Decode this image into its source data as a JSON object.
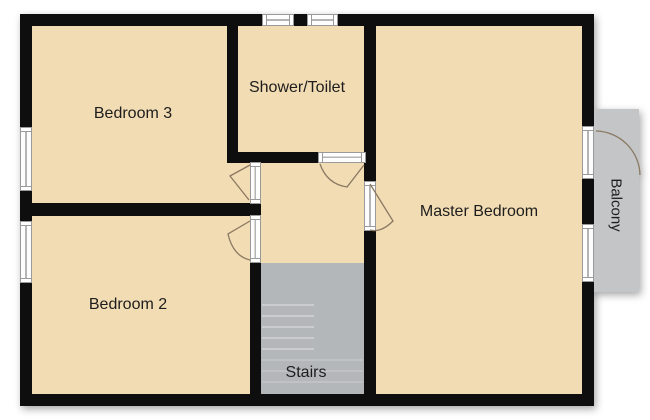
{
  "plan": {
    "rooms": {
      "bedroom3": {
        "label": "Bedroom 3"
      },
      "shower_toilet": {
        "label": "Shower/Toilet"
      },
      "master_bedroom": {
        "label": "Master Bedroom"
      },
      "bedroom2": {
        "label": "Bedroom 2"
      },
      "stairs": {
        "label": "Stairs"
      },
      "balcony": {
        "label": "Balcony"
      }
    },
    "colors": {
      "floor": "#f2dcb3",
      "wall": "#0e0e0e",
      "stairs": "#b4b7b9",
      "stair_tread": "#caccce",
      "balcony": "#c3c5c7",
      "window_frame": "#9a9a9a",
      "door_swing": "#8a7963",
      "label_text": "#1d1d1d",
      "background": "#ffffff"
    }
  }
}
